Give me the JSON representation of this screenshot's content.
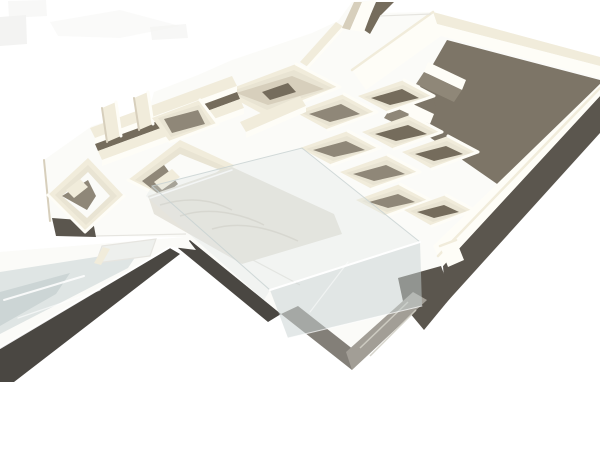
{
  "scene": {
    "type": "photograph",
    "subject": "White architectural scale model, oblique aerial view",
    "description": "Oblique aerial photograph of a white cardboard architectural model on a pure white background: maze-like clusters of roofless rooms, a tall walled courtyard on the right with deep warm-grey interior shadow, a central terrace with a clear acrylic cover over a textured sunken terrain strip, a long walkway with translucent glass inlay running off the lower-left edge, a grey concrete base corner at the bottom, and strong dark cast shadows falling toward the lower right.",
    "elements": [
      "photo artifacts top-left",
      "left room wing",
      "spine wall with stubs",
      "central room maze",
      "walled courtyard",
      "courtyard floor shadow",
      "courtyard partition walls",
      "terrace plaza",
      "terrain strip",
      "acrylic cover",
      "walkway with glass inlay",
      "concrete base corner",
      "cast shadows"
    ]
  },
  "palette": {
    "background": "#ffffff",
    "artifact_gray": "#f3f3f2",
    "base_white": "#fbfbf8",
    "wall_top": "#f1ecdb",
    "wall_lit": "#fefdf7",
    "wall_face": "#e9e4d3",
    "wall_shade": "#d7cfbc",
    "room_shadow": "#8f8778",
    "room_shadow_deep": "#756c5c",
    "court_shadow": "#7d7567",
    "cast_shadow": "#5b564e",
    "cast_shadow_dark": "#4a4742",
    "glass": "#dfe5e4",
    "glass_deep": "#c7d1d1",
    "glass_frost": "#eef0ed",
    "concrete": "#a29e96",
    "concrete_dark": "#837f78",
    "terrain": "#e6e4dc",
    "terrain_streak": "#d2cfc5",
    "seam": "#e6e5e0",
    "highlight_white": "#ffffff"
  }
}
